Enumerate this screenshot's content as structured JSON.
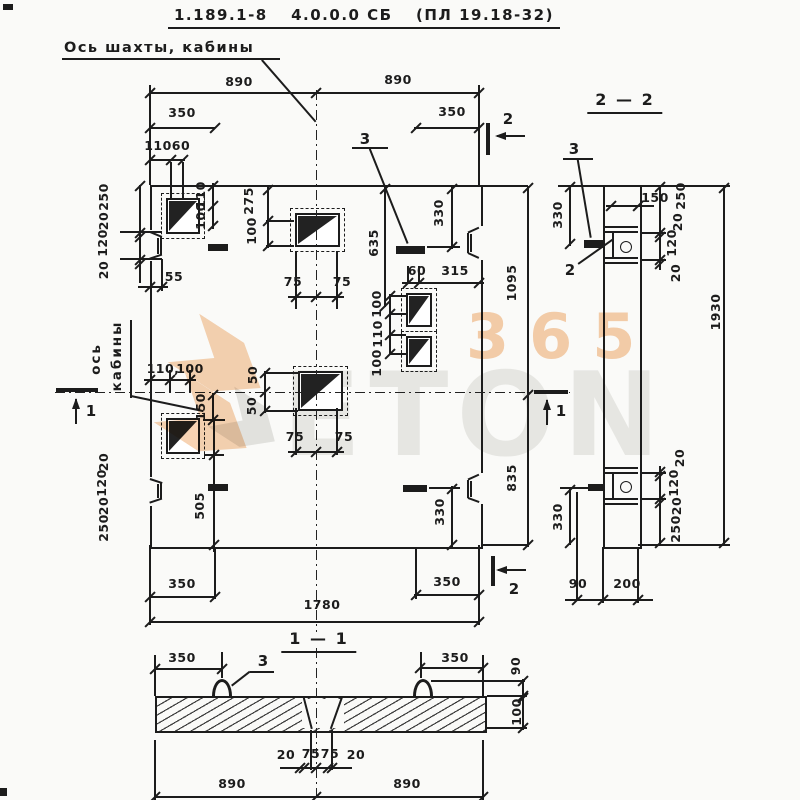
{
  "header": {
    "series": "1.189.1-8",
    "set": "4.0.0.0 СБ",
    "product": "(ПЛ 19.18-32)"
  },
  "annotations": {
    "axis_note": "Ось шахты, кабины",
    "axis_word1": "ось",
    "axis_word2": "кабины"
  },
  "section_titles": {
    "s22": "2 — 2",
    "s11": "1 — 1"
  },
  "section_marks": {
    "mark_1": "1",
    "mark_2": "2"
  },
  "callouts": {
    "embedded_item_3": "3",
    "detail_2": "2"
  },
  "watermark": {
    "grey_text": "ETON",
    "orange_text": "365",
    "orange": "#f0a868",
    "grey": "#e6e6e2"
  },
  "dim_labels": [
    {
      "t": "890",
      "x": 239,
      "y": 82
    },
    {
      "t": "890",
      "x": 398,
      "y": 80
    },
    {
      "t": "350",
      "x": 182,
      "y": 113
    },
    {
      "t": "350",
      "x": 452,
      "y": 112
    },
    {
      "t": "110",
      "x": 158,
      "y": 146
    },
    {
      "t": "60",
      "x": 181,
      "y": 146
    },
    {
      "t": "250",
      "x": 104,
      "y": 197,
      "r": 1
    },
    {
      "t": "20",
      "x": 104,
      "y": 221,
      "r": 1
    },
    {
      "t": "120",
      "x": 103,
      "y": 243,
      "r": 1
    },
    {
      "t": "20",
      "x": 104,
      "y": 270,
      "r": 1
    },
    {
      "t": "110",
      "x": 201,
      "y": 195,
      "r": 1
    },
    {
      "t": "100",
      "x": 201,
      "y": 216,
      "r": 1
    },
    {
      "t": "275",
      "x": 249,
      "y": 201,
      "r": 1
    },
    {
      "t": "100",
      "x": 252,
      "y": 231,
      "r": 1
    },
    {
      "t": "55",
      "x": 174,
      "y": 277
    },
    {
      "t": "75",
      "x": 293,
      "y": 282
    },
    {
      "t": "75",
      "x": 342,
      "y": 282
    },
    {
      "t": "635",
      "x": 374,
      "y": 243,
      "r": 1
    },
    {
      "t": "330",
      "x": 439,
      "y": 213,
      "r": 1
    },
    {
      "t": "60",
      "x": 417,
      "y": 271
    },
    {
      "t": "315",
      "x": 455,
      "y": 271
    },
    {
      "t": "100",
      "x": 377,
      "y": 304,
      "r": 1
    },
    {
      "t": "110",
      "x": 378,
      "y": 334,
      "r": 1
    },
    {
      "t": "100",
      "x": 377,
      "y": 363,
      "r": 1
    },
    {
      "t": "1095",
      "x": 512,
      "y": 283,
      "r": 1
    },
    {
      "t": "110,",
      "x": 163,
      "y": 369
    },
    {
      "t": "100",
      "x": 190,
      "y": 369
    },
    {
      "t": "150",
      "x": 201,
      "y": 407,
      "r": 1
    },
    {
      "t": "50",
      "x": 253,
      "y": 375,
      "r": 1
    },
    {
      "t": "50",
      "x": 252,
      "y": 406,
      "r": 1
    },
    {
      "t": "75",
      "x": 295,
      "y": 437
    },
    {
      "t": "75",
      "x": 344,
      "y": 437
    },
    {
      "t": "20",
      "x": 104,
      "y": 462,
      "r": 1
    },
    {
      "t": "120",
      "x": 102,
      "y": 483,
      "r": 1
    },
    {
      "t": "20",
      "x": 104,
      "y": 506,
      "r": 1
    },
    {
      "t": "250",
      "x": 104,
      "y": 528,
      "r": 1
    },
    {
      "t": "505",
      "x": 200,
      "y": 506,
      "r": 1
    },
    {
      "t": "330",
      "x": 440,
      "y": 512,
      "r": 1
    },
    {
      "t": "835",
      "x": 512,
      "y": 478,
      "r": 1
    },
    {
      "t": "350",
      "x": 182,
      "y": 584
    },
    {
      "t": "350",
      "x": 447,
      "y": 582
    },
    {
      "t": "1780",
      "x": 322,
      "y": 605
    },
    {
      "t": "330",
      "x": 558,
      "y": 215,
      "r": 1
    },
    {
      "t": "150",
      "x": 655,
      "y": 198
    },
    {
      "t": "250",
      "x": 681,
      "y": 196,
      "r": 1
    },
    {
      "t": "20",
      "x": 678,
      "y": 222,
      "r": 1
    },
    {
      "t": "120",
      "x": 672,
      "y": 243,
      "r": 1
    },
    {
      "t": "20",
      "x": 676,
      "y": 273,
      "r": 1
    },
    {
      "t": "20",
      "x": 680,
      "y": 458,
      "r": 1
    },
    {
      "t": "120",
      "x": 674,
      "y": 483,
      "r": 1
    },
    {
      "t": "20",
      "x": 677,
      "y": 506,
      "r": 1
    },
    {
      "t": "250",
      "x": 676,
      "y": 529,
      "r": 1
    },
    {
      "t": "330",
      "x": 558,
      "y": 517,
      "r": 1
    },
    {
      "t": "1930",
      "x": 716,
      "y": 312,
      "r": 1
    },
    {
      "t": "90",
      "x": 578,
      "y": 584
    },
    {
      "t": "200",
      "x": 627,
      "y": 584
    },
    {
      "t": "350",
      "x": 182,
      "y": 658
    },
    {
      "t": "350",
      "x": 455,
      "y": 658
    },
    {
      "t": "90",
      "x": 516,
      "y": 666,
      "r": 1
    },
    {
      "t": "100",
      "x": 517,
      "y": 712,
      "r": 1
    },
    {
      "t": "20",
      "x": 286,
      "y": 755
    },
    {
      "t": "75",
      "x": 311,
      "y": 754
    },
    {
      "t": "75",
      "x": 330,
      "y": 754
    },
    {
      "t": "20",
      "x": 356,
      "y": 755
    },
    {
      "t": "890",
      "x": 232,
      "y": 784
    },
    {
      "t": "890",
      "x": 407,
      "y": 784
    }
  ]
}
